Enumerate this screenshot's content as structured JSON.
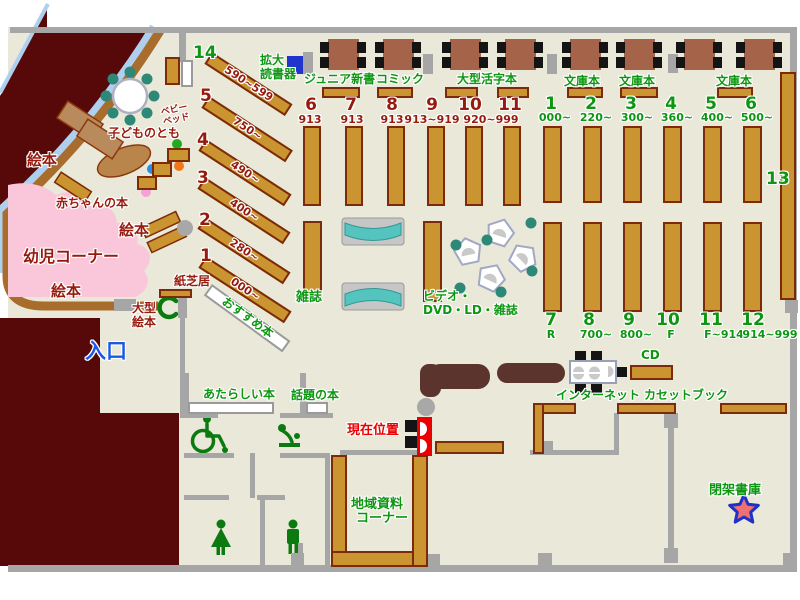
{
  "colors": {
    "floor": "#eae9d9",
    "exterior": "#570808",
    "wall": "#a6a6a6",
    "shelf": "#ca9530",
    "green_text": "#0d9612",
    "dark_red_text": "#961b0e",
    "marker_red": "#ea0000",
    "entrance_blue": "#1c57e8",
    "pink_area": "#f9c6da",
    "teal_bench": "#56c4be",
    "device_blue": "#2135cc"
  },
  "labels": {
    "magnifier_l1": "拡大",
    "magnifier_l2": "読書器",
    "junior_shinsho": "ジュニア新書",
    "comic": "コミック",
    "large_print": "大型活字本",
    "bunko1": "文庫本",
    "bunko2": "文庫本",
    "bunko3": "文庫本",
    "baby_bed_l1": "ベビー",
    "baby_bed_l2": "ベッド",
    "kodomo_no_tomo": "子どものとも",
    "ehon_left": "絵本",
    "ehon_mid": "絵本",
    "ehon_bottom": "絵本",
    "baby_books": "赤ちゃんの本",
    "infant_corner": "幼児コーナー",
    "large_ehon_l1": "大型",
    "large_ehon_l2": "絵本",
    "kamishibai": "紙芝居",
    "recommended": "おすすめ本",
    "entrance": "入口",
    "new_books": "あたらしい本",
    "topic_books": "話題の本",
    "magazines": "雑誌",
    "video_l1": "ビデオ・",
    "video_l2": "DVD・LD・雑誌",
    "internet": "インターネット",
    "cd": "CD",
    "cassette_book": "カセットブック",
    "current_position": "現在位置",
    "local_docs_l1": "地域資料",
    "local_docs_l2": "コーナー",
    "closed_stacks": "閉架書庫",
    "shelf13": "13"
  },
  "teen_diagonal_shelves": [
    {
      "no": "14",
      "range": "590~599"
    },
    {
      "no": "5",
      "range": "750~"
    },
    {
      "no": "4",
      "range": "490~"
    },
    {
      "no": "3",
      "range": "400~"
    },
    {
      "no": "2",
      "range": "280~"
    },
    {
      "no": "1",
      "range": "000~"
    }
  ],
  "center_stacks": [
    {
      "no": "6",
      "range": "913"
    },
    {
      "no": "7",
      "range": "913"
    },
    {
      "no": "8",
      "range": "913"
    },
    {
      "no": "9",
      "range": "913~919"
    },
    {
      "no": "10",
      "range": "920~999"
    },
    {
      "no": "11",
      "range": ""
    }
  ],
  "right_stacks_north": [
    {
      "no": "1",
      "range": "000~"
    },
    {
      "no": "2",
      "range": "220~"
    },
    {
      "no": "3",
      "range": "300~"
    },
    {
      "no": "4",
      "range": "360~"
    },
    {
      "no": "5",
      "range": "400~"
    },
    {
      "no": "6",
      "range": "500~"
    }
  ],
  "right_stacks_south": [
    {
      "no": "7",
      "range": "R"
    },
    {
      "no": "8",
      "range": "700~"
    },
    {
      "no": "9",
      "range": "800~"
    },
    {
      "no": "10",
      "range": "F"
    },
    {
      "no": "11",
      "range": "F~914"
    },
    {
      "no": "12",
      "range": "914~999"
    }
  ],
  "icons": {
    "wheelchair": "wheelchair-icon",
    "baby_change": "baby-change-icon",
    "toilet_woman": "woman-icon",
    "toilet_man": "man-icon",
    "phone": "phone-icon",
    "closed_stacks_star": "star-icon",
    "current_position_marker": "you-are-here-marker"
  }
}
